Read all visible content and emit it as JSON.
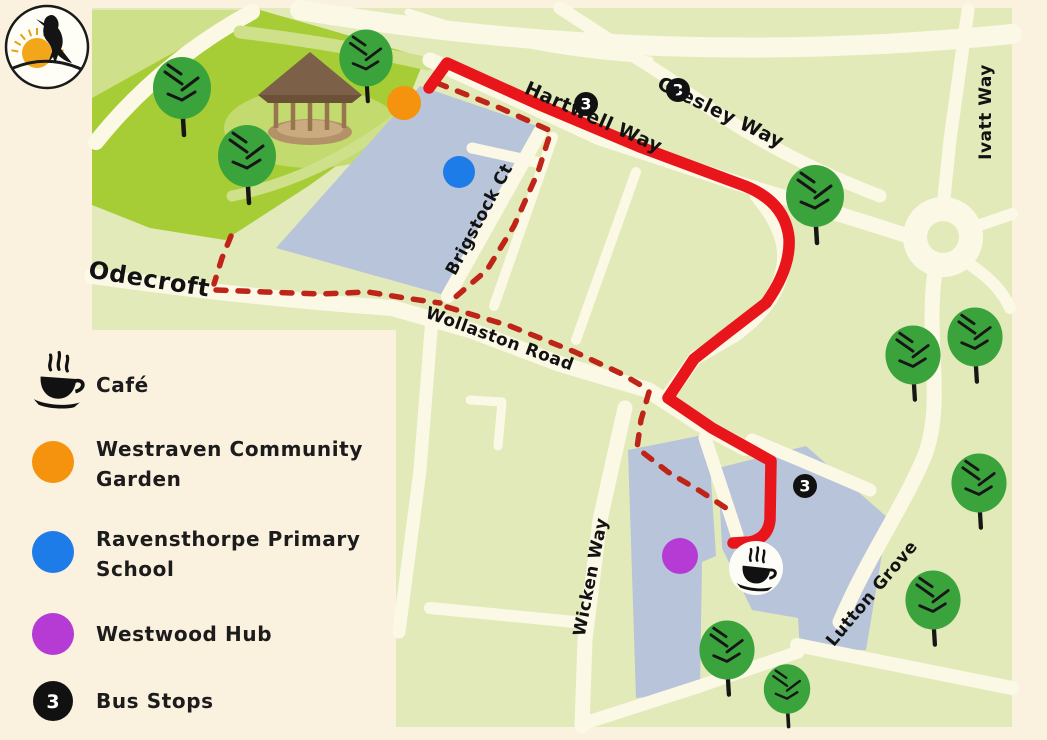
{
  "logo": {
    "icon": "raven-and-sun-logo"
  },
  "legend": {
    "items": [
      {
        "id": "cafe",
        "icon": "coffee-cup-icon",
        "label": "Café"
      },
      {
        "id": "westraven-community-garden",
        "marker_color": "#f5920e",
        "lines": [
          "Westraven Community",
          "Garden"
        ]
      },
      {
        "id": "ravensthorpe-primary-school",
        "marker_color": "#1d7ce8",
        "lines": [
          "Ravensthorpe Primary",
          "School"
        ]
      },
      {
        "id": "westwood-hub",
        "marker_color": "#b63bd4",
        "label": "Westwood Hub"
      },
      {
        "id": "bus-stops",
        "symbol": "3",
        "marker_color": "#111111",
        "label": "Bus Stops"
      }
    ]
  },
  "map": {
    "streets": [
      {
        "name": "Hartwell Way"
      },
      {
        "name": "Gresley Way"
      },
      {
        "name": "Ivatt Way"
      },
      {
        "name": "Odecroft"
      },
      {
        "name": "Brigstock Ct"
      },
      {
        "name": "Wollaston Road"
      },
      {
        "name": "Wicken Way"
      },
      {
        "name": "Lutton Grove"
      }
    ],
    "bus_stop_symbol": "3",
    "markers": {
      "community_garden_color": "#f5920e",
      "school_color": "#1d7ce8",
      "hub_color": "#b63bd4"
    },
    "route_color": "#e8151a",
    "dashed_path_color": "#bf2418"
  },
  "colors": {
    "background": "#faf1df",
    "map_green": "#e2eaba",
    "park_green": "#a6cd35",
    "park_light": "#cfe08a",
    "road": "#fcf8e6",
    "building": "#b8c4d9",
    "tree_green": "#3ba33c"
  }
}
